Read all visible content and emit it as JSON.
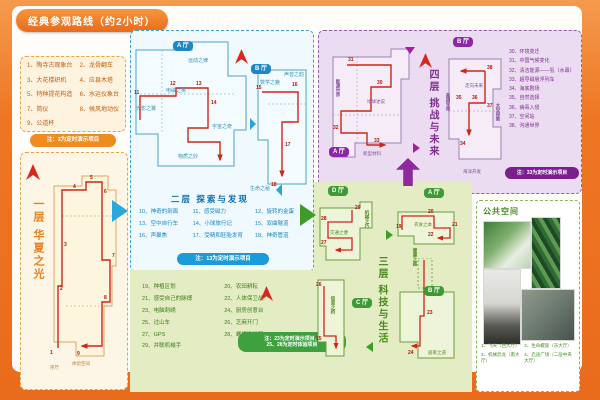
{
  "title": "经典参观路线（约2小时）",
  "colors": {
    "frame": "#ee7623",
    "floor1": "#e8821e",
    "floor2": "#1b9cd8",
    "floor3": "#4a9a28",
    "floor4": "#8e2a9e",
    "route": "#cf2617"
  },
  "floor1": {
    "name": "一层  华夏之光",
    "items": [
      "1、陶寺古观象台",
      "2、龙骨翻车",
      "3、大花楼织机",
      "4、应县木塔",
      "5、特种提花构造",
      "6、水运仪象台",
      "7、简仪",
      "8、候风地动仪",
      "9、公道杯"
    ],
    "note": "注：3为定时演示项目",
    "map_labels": [
      "序厅",
      "体验空间"
    ],
    "route": [
      "1",
      "2",
      "3",
      "4",
      "5",
      "6",
      "7",
      "8",
      "9"
    ]
  },
  "floor2": {
    "name": "二层  探索与发现",
    "halls": [
      "A 厅",
      "B 厅"
    ],
    "zones": [
      "运动之律",
      "光影之翼",
      "电磁之奥",
      "宇宙之奇",
      "物质之妙",
      "数学之魅",
      "声音之韵",
      "生命之秘"
    ],
    "items": [
      "10、神奇的剖面",
      "11、感受磁力",
      "12、旋转的金蛋",
      "13、空中自行车",
      "14、小球旅行记",
      "15、双曲隧道",
      "16、声聚焦",
      "17、受精和胚胎发育",
      "18、神奇管道"
    ],
    "note": "注：13为定时演示项目",
    "route": [
      "11",
      "12",
      "13",
      "14",
      "15",
      "16",
      "17",
      "18"
    ]
  },
  "floor3": {
    "name": "三层  科技与生活",
    "halls": [
      "A 厅",
      "B 厅",
      "C 厅",
      "D 厅"
    ],
    "zones": [
      "衣食之本",
      "健康之路",
      "居家之道",
      "信息之桥",
      "交通之便",
      "机械之巧"
    ],
    "items": [
      "19、种植区划",
      "20、农田耕耘",
      "21、感受自己的脉搏",
      "22、人体保卫战",
      "23、电脑刺绣",
      "24、厨房创意台",
      "25、过山车",
      "26、芝麻开门",
      "27、GPS",
      "28、螺旋推进器",
      "29、并联机械手"
    ],
    "note1": "注：23为定时演示项目，",
    "note2": "25、28为定时体验项目",
    "route": [
      "19",
      "20",
      "21",
      "22",
      "23",
      "24",
      "25",
      "26",
      "27",
      "28",
      "29"
    ]
  },
  "floor4": {
    "name": "四层  挑战与未来",
    "halls": [
      "A 厅",
      "B 厅"
    ],
    "zones": [
      "能源世界",
      "地球述说",
      "新型材料",
      "走向未来",
      "基因生命",
      "太空探索",
      "海洋开发"
    ],
    "items": [
      "30、环境变迁",
      "31、中国气候变化",
      "32、清洁能源——氢（水幕）",
      "33、超导磁悬浮列车",
      "34、海底剧场",
      "35、自然选择",
      "36、病毒入侵",
      "37、空间站",
      "38、沟通世界"
    ],
    "note": "注：33为定时演示项目",
    "route": [
      "30",
      "31",
      "32",
      "33",
      "34",
      "35",
      "36",
      "37",
      "38"
    ]
  },
  "public": {
    "title": "公共空间",
    "captions": [
      "1、飞天（西大厅）",
      "2、生命螺旋（东大厅）",
      "3、机械恐龙（南大厅）",
      "4、启迪广场（二层中央大厅）"
    ]
  }
}
